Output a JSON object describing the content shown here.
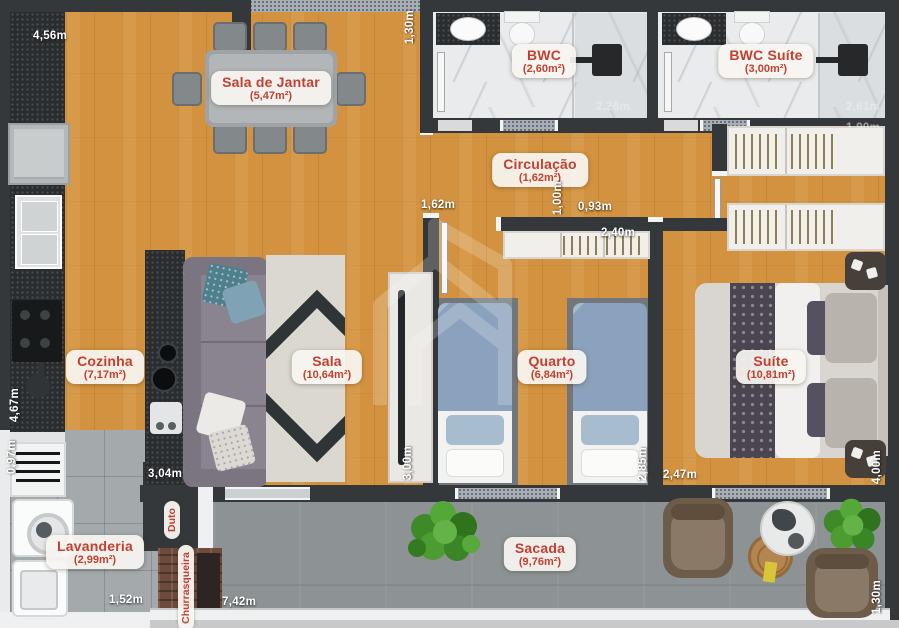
{
  "colors": {
    "accent_text": "#c2402f",
    "wall": "#35383b",
    "wood_floor": "#d2923f",
    "balcony_floor": "#8d9394",
    "label_background": "#f6f4f0"
  },
  "watermark_icon": "house-buildings-logo",
  "rooms": [
    {
      "name": "Sala de Jantar",
      "area": "(5,47m²)"
    },
    {
      "name": "BWC",
      "area": "(2,60m²)"
    },
    {
      "name": "BWC Suíte",
      "area": "(3,00m²)"
    },
    {
      "name": "Circulação",
      "area": "(1,62m²)"
    },
    {
      "name": "Cozinha",
      "area": "(7,17m²)"
    },
    {
      "name": "Sala",
      "area": "(10,64m²)"
    },
    {
      "name": "Quarto",
      "area": "(6,84m²)"
    },
    {
      "name": "Suíte",
      "area": "(10,81m²)"
    },
    {
      "name": "Lavanderia",
      "area": "(2,99m²)"
    },
    {
      "name": "Sacada",
      "area": "(9,76m²)"
    }
  ],
  "labels": {
    "duto": "Duto",
    "churrasqueira": "Churrasqueira"
  },
  "dimensions": [
    "4,56m",
    "1,30m",
    "2,26m",
    "2,61m",
    "1,90m",
    "1,62m",
    "1,00m",
    "0,93m",
    "2,40m",
    "4,67m",
    "0,97m",
    "3,04m",
    "3,00m",
    "2,85m",
    "2,47m",
    "4,00m",
    "1,52m",
    "7,42m",
    "1,30m"
  ]
}
